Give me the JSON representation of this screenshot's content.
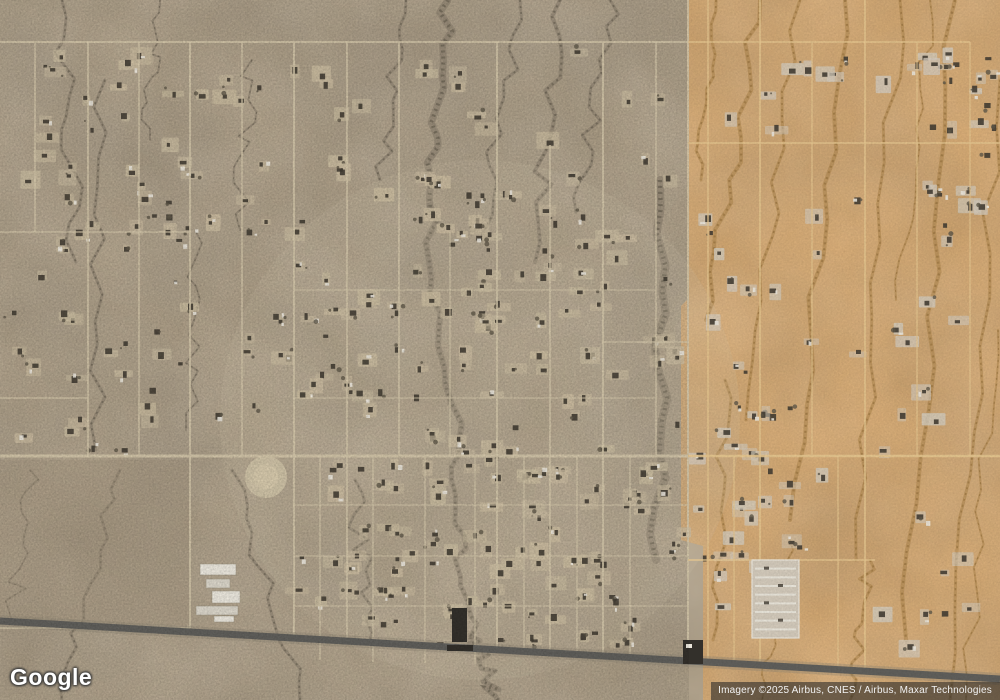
{
  "branding": {
    "logo_text": "Google"
  },
  "attribution": {
    "text": "Imagery ©2025 Airbus, CNES / Airbus, Maxar Technologies"
  },
  "map": {
    "width": 1000,
    "height": 700,
    "palette": {
      "left_base": "#b3a48c",
      "left_dark": "#7f7463",
      "left_light": "#cfc2a6",
      "left_veg": "#5f5748",
      "right_base": "#d9ad76",
      "right_dark": "#aa8148",
      "right_light": "#e8c792",
      "right_veg": "#8f6c38",
      "road_left": "#d4c7aa",
      "road_right": "#e5c68f",
      "highway": "#605f5b",
      "highway_shoulder": "#8b8374",
      "building_dark": "#403a31",
      "building_white": "#eae6dc",
      "lot_left": "#cabca0",
      "lot_right": "#d2c9ba",
      "parcel_dark": "#a2947e",
      "town_light": "#d6c9ac"
    },
    "zones": {
      "boundary_path": "M687,0 L687,300 L681,306 L681,540 L703,546 L703,700 L1000,700 L1000,0 Z",
      "left_clip": [
        0,
        0,
        689,
        700
      ]
    },
    "washes_left": [
      {
        "x1": 448,
        "y1": 0,
        "x2": 430,
        "y2": 210,
        "w": 7
      },
      {
        "x1": 430,
        "y1": 205,
        "x2": 458,
        "y2": 456,
        "w": 6
      },
      {
        "x1": 458,
        "y1": 456,
        "x2": 470,
        "y2": 640,
        "w": 5
      },
      {
        "x1": 470,
        "y1": 635,
        "x2": 498,
        "y2": 700,
        "w": 5
      },
      {
        "x1": 406,
        "y1": 0,
        "x2": 380,
        "y2": 180,
        "w": 3
      },
      {
        "x1": 520,
        "y1": 0,
        "x2": 482,
        "y2": 235,
        "w": 3
      },
      {
        "x1": 560,
        "y1": 0,
        "x2": 535,
        "y2": 262,
        "w": 4
      },
      {
        "x1": 610,
        "y1": 0,
        "x2": 576,
        "y2": 212,
        "w": 3
      },
      {
        "x1": 660,
        "y1": 180,
        "x2": 656,
        "y2": 560,
        "w": 8
      },
      {
        "x1": 62,
        "y1": 0,
        "x2": 76,
        "y2": 262,
        "w": 3
      },
      {
        "x1": 105,
        "y1": 80,
        "x2": 96,
        "y2": 450,
        "w": 3
      },
      {
        "x1": 160,
        "y1": 0,
        "x2": 150,
        "y2": 140,
        "w": 2
      },
      {
        "x1": 232,
        "y1": 470,
        "x2": 300,
        "y2": 700,
        "w": 3
      },
      {
        "x1": 120,
        "y1": 470,
        "x2": 62,
        "y2": 700,
        "w": 3
      },
      {
        "x1": 30,
        "y1": 470,
        "x2": 12,
        "y2": 622,
        "w": 2
      },
      {
        "x1": 355,
        "y1": 480,
        "x2": 370,
        "y2": 640,
        "w": 3
      },
      {
        "x1": 252,
        "y1": 60,
        "x2": 240,
        "y2": 230,
        "w": 2
      },
      {
        "x1": 196,
        "y1": 232,
        "x2": 186,
        "y2": 430,
        "w": 2
      }
    ],
    "washes_right": [
      {
        "x1": 760,
        "y1": 0,
        "x2": 706,
        "y2": 320,
        "w": 4
      },
      {
        "x1": 800,
        "y1": 0,
        "x2": 746,
        "y2": 420,
        "w": 3
      },
      {
        "x1": 845,
        "y1": 0,
        "x2": 790,
        "y2": 520,
        "w": 4
      },
      {
        "x1": 900,
        "y1": 0,
        "x2": 856,
        "y2": 560,
        "w": 3
      },
      {
        "x1": 955,
        "y1": 0,
        "x2": 906,
        "y2": 640,
        "w": 4
      },
      {
        "x1": 1000,
        "y1": 80,
        "x2": 950,
        "y2": 700,
        "w": 3
      },
      {
        "x1": 998,
        "y1": 330,
        "x2": 966,
        "y2": 700,
        "w": 2
      },
      {
        "x1": 725,
        "y1": 380,
        "x2": 713,
        "y2": 640,
        "w": 3
      },
      {
        "x1": 790,
        "y1": 540,
        "x2": 762,
        "y2": 700,
        "w": 2
      },
      {
        "x1": 870,
        "y1": 560,
        "x2": 850,
        "y2": 700,
        "w": 3
      },
      {
        "x1": 930,
        "y1": 0,
        "x2": 896,
        "y2": 300,
        "w": 2
      },
      {
        "x1": 716,
        "y1": 0,
        "x2": 701,
        "y2": 180,
        "w": 3
      }
    ],
    "roads_vertical": [
      {
        "x": 35,
        "y0": 42,
        "y1": 232,
        "w": 1.4,
        "z": "L"
      },
      {
        "x": 88,
        "y0": 42,
        "y1": 456,
        "w": 1.6,
        "z": "L"
      },
      {
        "x": 139,
        "y0": 42,
        "y1": 456,
        "w": 1.4,
        "z": "L"
      },
      {
        "x": 190,
        "y0": 42,
        "y1": 628,
        "w": 1.8,
        "z": "L"
      },
      {
        "x": 242,
        "y0": 42,
        "y1": 456,
        "w": 1.4,
        "z": "L"
      },
      {
        "x": 294,
        "y0": 42,
        "y1": 638,
        "w": 1.8,
        "z": "L"
      },
      {
        "x": 320,
        "y0": 456,
        "y1": 660,
        "w": 1.2,
        "z": "L"
      },
      {
        "x": 347,
        "y0": 42,
        "y1": 641,
        "w": 1.6,
        "z": "L"
      },
      {
        "x": 373,
        "y0": 456,
        "y1": 662,
        "w": 1.2,
        "z": "L"
      },
      {
        "x": 399,
        "y0": 42,
        "y1": 456,
        "w": 1.6,
        "z": "L"
      },
      {
        "x": 425,
        "y0": 456,
        "y1": 663,
        "w": 1.2,
        "z": "L"
      },
      {
        "x": 450,
        "y0": 232,
        "y1": 456,
        "w": 1.2,
        "z": "L"
      },
      {
        "x": 475,
        "y0": 456,
        "y1": 664,
        "w": 1.2,
        "z": "L"
      },
      {
        "x": 497,
        "y0": 42,
        "y1": 650,
        "w": 1.8,
        "z": "L"
      },
      {
        "x": 524,
        "y0": 456,
        "y1": 652,
        "w": 1.2,
        "z": "L"
      },
      {
        "x": 550,
        "y0": 145,
        "y1": 653,
        "w": 1.6,
        "z": "L"
      },
      {
        "x": 577,
        "y0": 456,
        "y1": 655,
        "w": 1.2,
        "z": "L"
      },
      {
        "x": 603,
        "y0": 42,
        "y1": 656,
        "w": 1.8,
        "z": "L"
      },
      {
        "x": 630,
        "y0": 456,
        "y1": 658,
        "w": 1.2,
        "z": "L"
      },
      {
        "x": 656,
        "y0": 42,
        "y1": 456,
        "w": 1.4,
        "z": "L"
      },
      {
        "x": 688,
        "y0": 0,
        "y1": 662,
        "w": 2,
        "z": "L"
      },
      {
        "x": 708,
        "y0": 0,
        "y1": 662,
        "w": 1.4,
        "z": "R"
      },
      {
        "x": 734,
        "y0": 456,
        "y1": 664,
        "w": 1.2,
        "z": "R"
      },
      {
        "x": 760,
        "y0": 0,
        "y1": 666,
        "w": 1.6,
        "z": "R"
      },
      {
        "x": 812,
        "y0": 42,
        "y1": 456,
        "w": 1.2,
        "z": "R"
      },
      {
        "x": 838,
        "y0": 456,
        "y1": 670,
        "w": 1.2,
        "z": "R"
      },
      {
        "x": 865,
        "y0": 0,
        "y1": 672,
        "w": 1.6,
        "z": "R"
      },
      {
        "x": 917,
        "y0": 42,
        "y1": 456,
        "w": 1.2,
        "z": "R"
      },
      {
        "x": 970,
        "y0": 42,
        "y1": 456,
        "w": 1.2,
        "z": "R"
      }
    ],
    "roads_horizontal": [
      {
        "y": 42,
        "x0": 0,
        "x1": 688,
        "w": 1.8,
        "z": "L"
      },
      {
        "y": 42,
        "x0": 688,
        "x1": 970,
        "w": 1.4,
        "z": "R"
      },
      {
        "y": 143,
        "x0": 688,
        "x1": 1000,
        "w": 1.4,
        "z": "R"
      },
      {
        "y": 232,
        "x0": 0,
        "x1": 190,
        "w": 1.2,
        "z": "L"
      },
      {
        "y": 290,
        "x0": 294,
        "x1": 656,
        "w": 1,
        "z": "L"
      },
      {
        "y": 342,
        "x0": 603,
        "x1": 688,
        "w": 1.2,
        "z": "L"
      },
      {
        "y": 398,
        "x0": 294,
        "x1": 656,
        "w": 1,
        "z": "L"
      },
      {
        "y": 398,
        "x0": 0,
        "x1": 88,
        "w": 1.2,
        "z": "L"
      },
      {
        "y": 456,
        "x0": 0,
        "x1": 688,
        "w": 3,
        "z": "L"
      },
      {
        "y": 456,
        "x0": 688,
        "x1": 1000,
        "w": 2.6,
        "z": "R"
      },
      {
        "y": 505,
        "x0": 294,
        "x1": 688,
        "w": 0.9,
        "z": "L"
      },
      {
        "y": 556,
        "x0": 294,
        "x1": 688,
        "w": 0.9,
        "z": "L"
      },
      {
        "y": 606,
        "x0": 294,
        "x1": 688,
        "w": 0.9,
        "z": "L"
      },
      {
        "y": 560,
        "x0": 688,
        "x1": 875,
        "w": 1.4,
        "z": "R"
      },
      {
        "y": 628,
        "x0": 0,
        "x1": 190,
        "w": 1.4,
        "z": "L"
      }
    ],
    "highway": {
      "y_left": 621,
      "y_right": 679,
      "width": 7
    },
    "lot_regions": [
      {
        "x": 40,
        "y": 48,
        "w": 620,
        "h": 125,
        "n": 40,
        "z": "L"
      },
      {
        "x": 55,
        "y": 175,
        "w": 250,
        "h": 280,
        "n": 48,
        "z": "L"
      },
      {
        "x": 300,
        "y": 175,
        "w": 380,
        "h": 280,
        "n": 100,
        "z": "L"
      },
      {
        "x": 295,
        "y": 460,
        "w": 390,
        "h": 185,
        "n": 100,
        "z": "L"
      },
      {
        "x": 10,
        "y": 40,
        "w": 60,
        "h": 400,
        "n": 10,
        "z": "L"
      },
      {
        "x": 700,
        "y": 40,
        "w": 290,
        "h": 610,
        "n": 55,
        "z": "R"
      },
      {
        "x": 925,
        "y": 55,
        "w": 70,
        "h": 175,
        "n": 22,
        "z": "R"
      },
      {
        "x": 697,
        "y": 395,
        "w": 125,
        "h": 165,
        "n": 16,
        "z": "R"
      }
    ],
    "seed": 1337,
    "landmarks": {
      "arena": {
        "cx": 266,
        "cy": 477,
        "r": 21
      },
      "open_parcel": {
        "x": 0,
        "y": 460,
        "w": 190,
        "h": 165
      },
      "town_glow": {
        "cx": 480,
        "cy": 420,
        "rx": 260,
        "ry": 260
      },
      "school_rects": [
        [
          200,
          564,
          36,
          11
        ],
        [
          206,
          579,
          24,
          9
        ],
        [
          212,
          591,
          28,
          12
        ],
        [
          196,
          606,
          42,
          9
        ],
        [
          214,
          616,
          20,
          6
        ]
      ],
      "rv_park": {
        "x": 752,
        "y": 560,
        "w": 47,
        "h": 78,
        "rows": 8
      },
      "dark_buildings": [
        [
          452,
          608,
          15,
          34
        ],
        [
          683,
          640,
          20,
          24
        ],
        [
          447,
          645,
          26,
          6
        ]
      ]
    }
  }
}
